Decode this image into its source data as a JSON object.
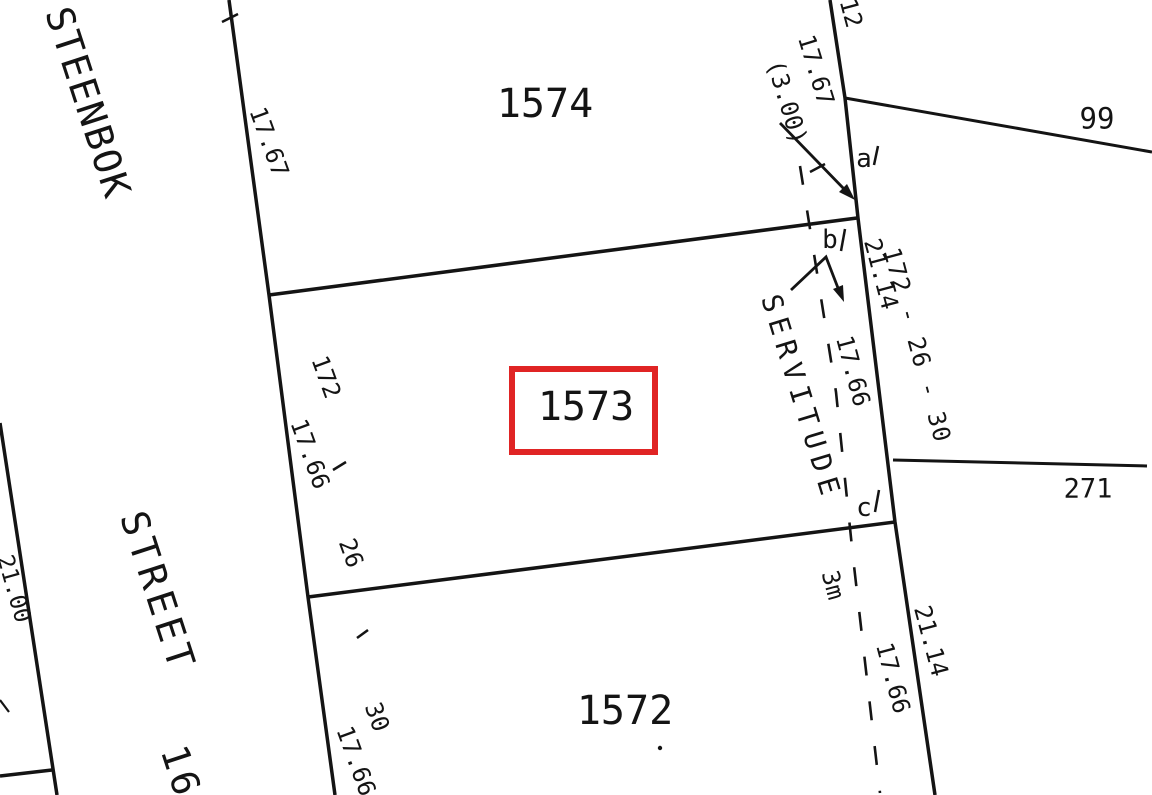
{
  "colors": {
    "ink": "#141414",
    "highlight": "#e02424",
    "background": "#ffffff"
  },
  "street": {
    "name_top": "STEENBOK",
    "name_bottom": "STREET",
    "number": "16"
  },
  "parcels": {
    "p1574": "1574",
    "p1573": "1573",
    "p1572": "1572",
    "p99": "99",
    "p271": "271"
  },
  "points": {
    "a": "a",
    "b": "b",
    "c": "c"
  },
  "servitude": {
    "label": "SERVITUDE",
    "width": "3m",
    "offset": "(3.00)"
  },
  "dims": {
    "top_partial": "202",
    "street_1767": "17.67",
    "right_top_partial": "12",
    "right_1767": "17.67",
    "right_2114_upper": "21.14",
    "right_sequence": "172 - 26 - 30",
    "servitude_1766": "17.66",
    "street_172": "172",
    "street_1766_upper": "17.66",
    "street_26": "26",
    "street_30": "30",
    "street_1766_lower": "17.66",
    "bottomright_1766": "17.66",
    "bottomright_2114": "21.14",
    "left_2100": "21.00"
  }
}
